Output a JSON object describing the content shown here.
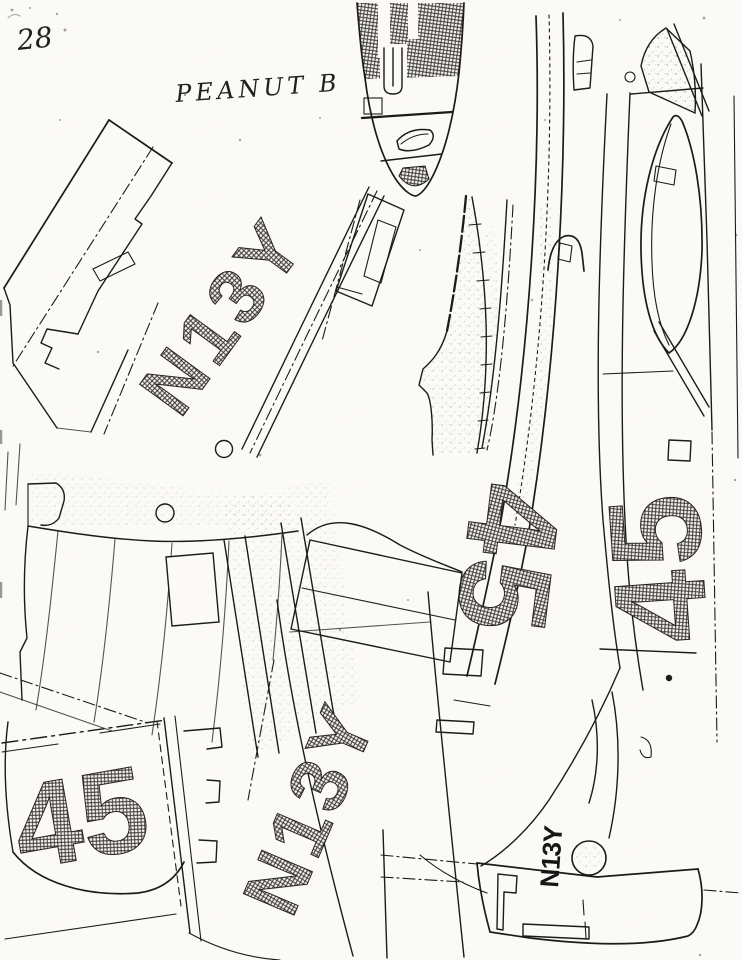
{
  "page": {
    "number": "28",
    "title": "PEANUT B"
  },
  "markings": {
    "wing_top_registration": "N13Y",
    "bottom_panel_registration": "N13Y",
    "tail_registration": "N13Y",
    "wing_race_number": "45",
    "fuselage_left_race_number": "45",
    "fuselage_right_race_number": "45"
  },
  "colors": {
    "paper": "#fbfaf6",
    "ink": "#1b1b1b"
  }
}
